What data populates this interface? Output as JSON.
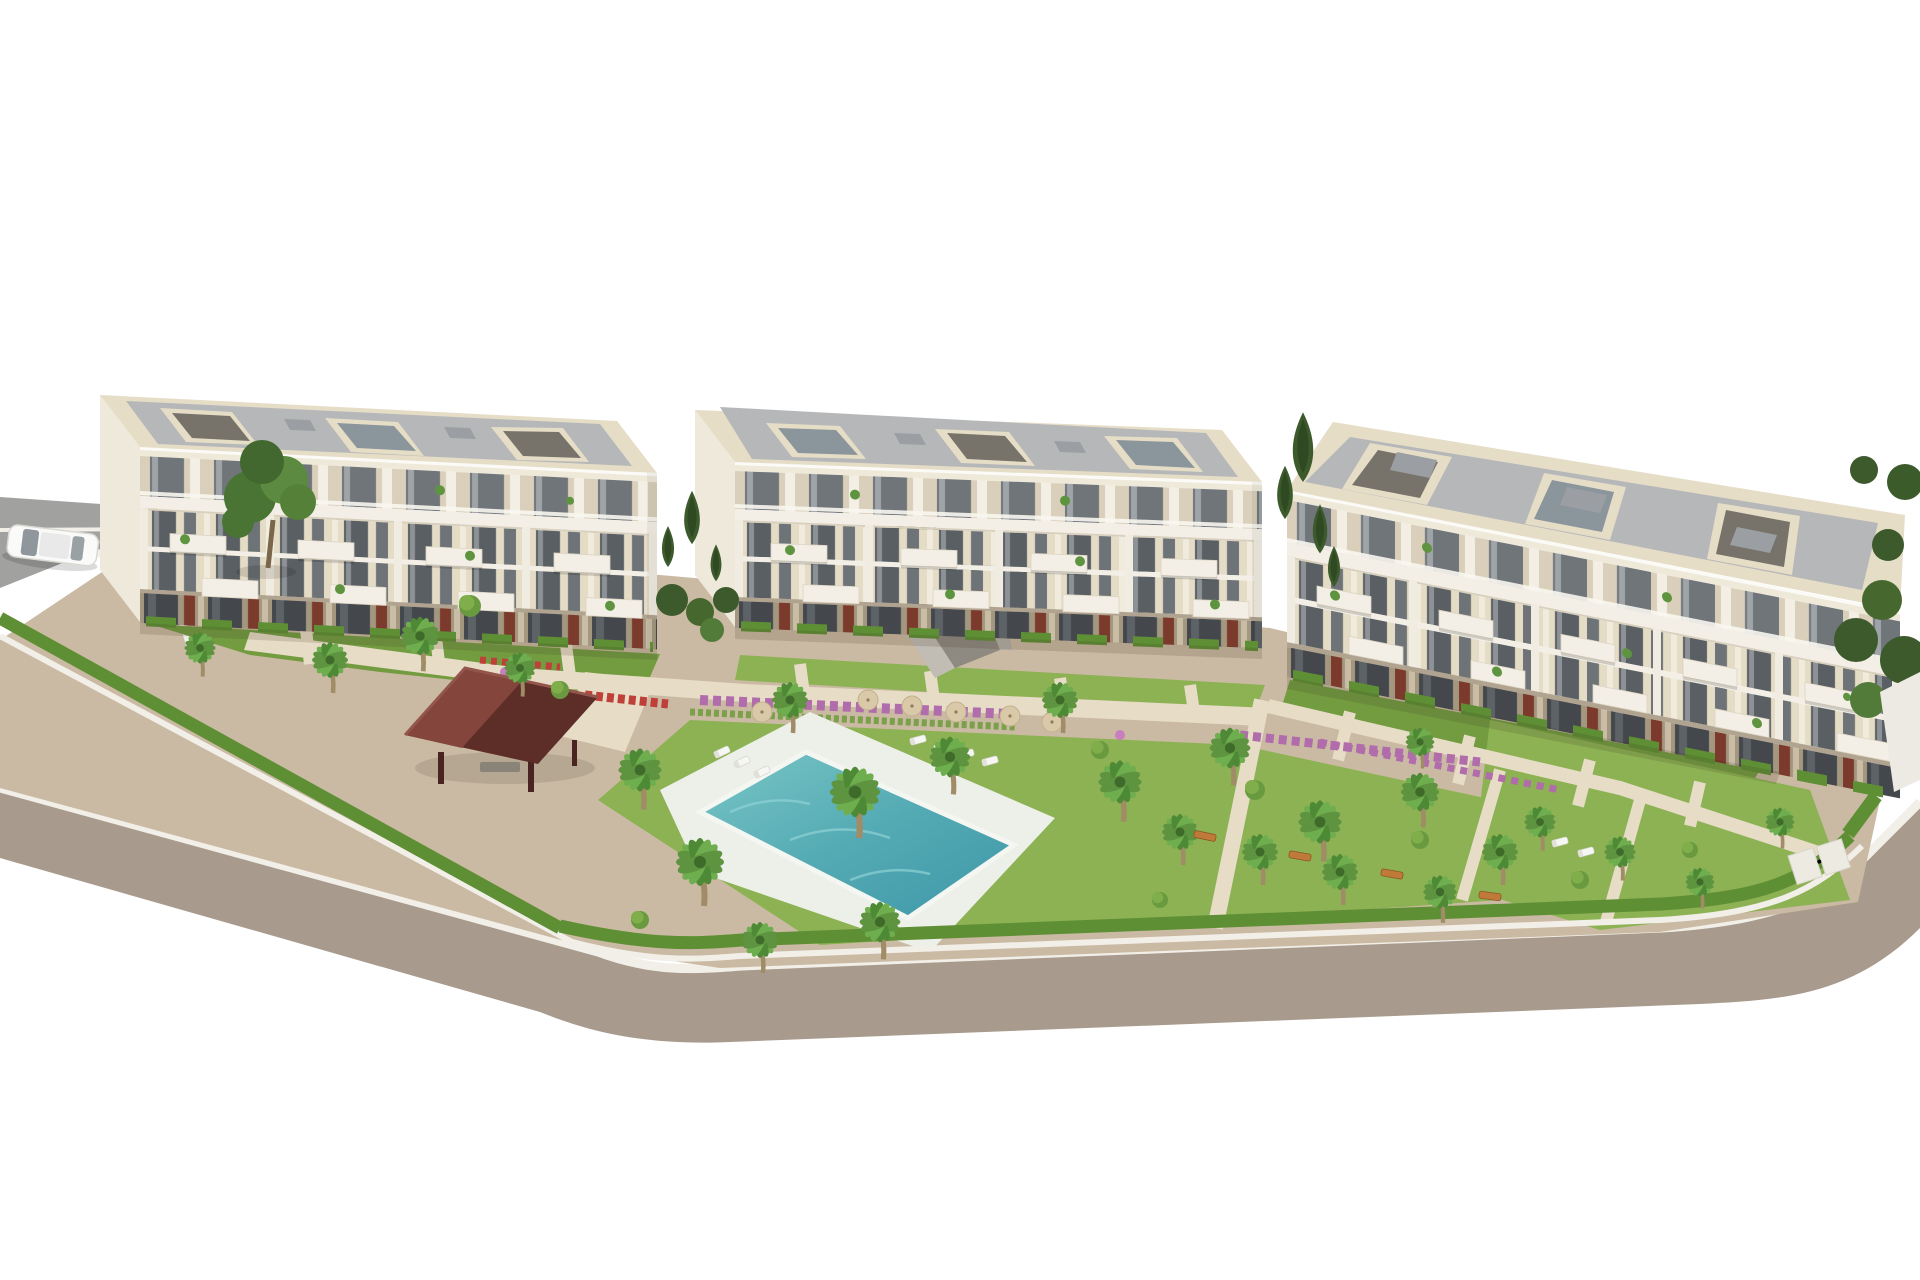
{
  "scene": {
    "type": "3d-architectural-render",
    "description": "Aerial 3D rendering of a new-build residential complex on a white background: three cream four-storey apartment buildings with grey flat roofs, glass balconies and terracotta ground-floor panels, landscaped communal gardens with palm trees, flower beds, a turquoise swimming pool with sun loungers and parasols, a dark-red timber gazebo, an underground garage ramp, and a curved grey perimeter road with a white car at the top left.",
    "objects": {
      "apartment_buildings": 3,
      "storeys_per_building": 4,
      "swimming_pools": 1,
      "gazebos": 1,
      "cars": 1,
      "garage_ramps": 1,
      "palm_trees": 26,
      "cypress_trees": 7,
      "deciduous_trees": 1,
      "sun_umbrellas": 6,
      "sun_loungers": 9,
      "garden_benches": 4,
      "flower_beds": 6
    }
  },
  "colors": {
    "bg": "#ffffff",
    "road": "#a89a8c",
    "road_top": "#a1a19f",
    "sidewalk": "#f2efe8",
    "pavement": "#cbbaa3",
    "walkway": "#e7dcc6",
    "lawn": "#8cb253",
    "lawn_dark": "#739c41",
    "hedge": "#5f8f35",
    "tree_dark": "#3c5a2b",
    "palm_green": "#5e9440",
    "palm_trunk": "#a08c66",
    "pool_water": "#53aab4",
    "pool_deck": "#edefe9",
    "wall_cream": "#e6ddc7",
    "wall_beige": "#d9cfba",
    "wall_light": "#f3efe6",
    "roof_grey": "#b6b7b9",
    "window_dark": "#5a5f63",
    "ground_dark": "#a3977f",
    "opening_dark": "#43474b",
    "accent_red": "#7b3a2b",
    "gazebo_dark": "#5d2d27",
    "gazebo_light": "#83453c",
    "flower_pink": "#b06cab",
    "flower_red": "#bf4038",
    "bench": "#bf7a39",
    "umbrella": "#d9c9a8",
    "car_white": "#fafaf8"
  }
}
